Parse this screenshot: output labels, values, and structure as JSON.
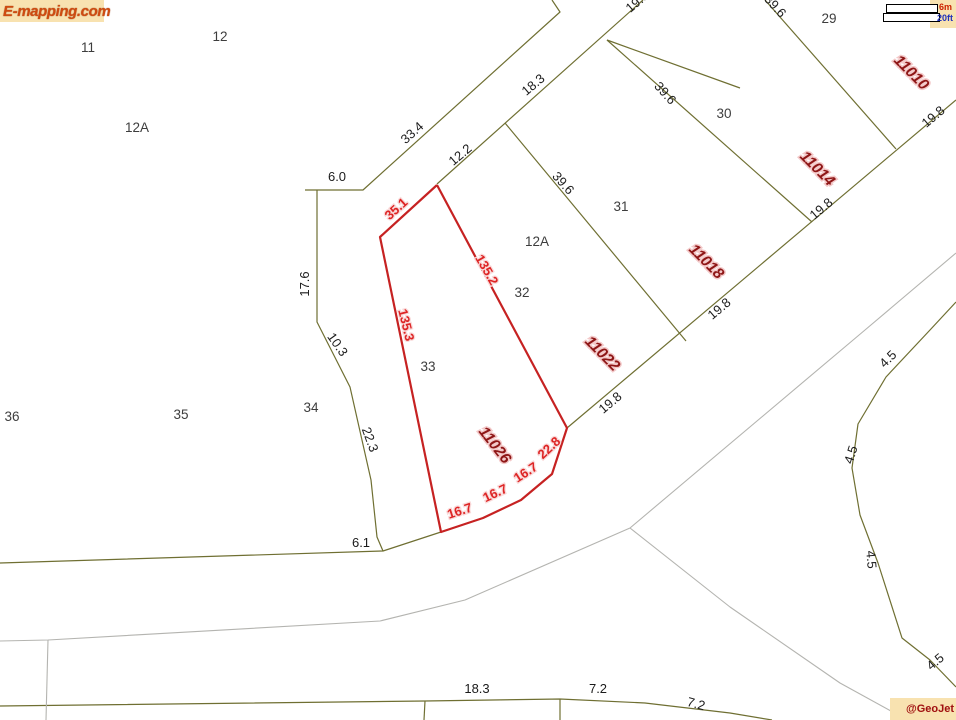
{
  "branding": {
    "logo": "E-mapping.com",
    "credit": "@GeoJet"
  },
  "scalebar": {
    "metric": "6m",
    "imperial": "20ft"
  },
  "colors": {
    "parcel": "#6f6f32",
    "road": "#b4b4b0",
    "highlight": "#c62222",
    "dim_text": "#1b1b1b",
    "lot_text": "#3d3d3d",
    "address_text": "#8e1616",
    "red_dim_text": "#dd2424",
    "badge_bg": "#f8e2b0",
    "logo_text": "#cf4b10",
    "scale_metric": "#cc2200",
    "scale_imperial": "#2233bb"
  },
  "map": {
    "width": 956,
    "height": 720,
    "lines": [
      {
        "name": "road-upper-left-edge",
        "stroke": "parcel",
        "width": 1.2,
        "points": [
          [
            305,
            190
          ],
          [
            363,
            190
          ],
          [
            560,
            12
          ],
          [
            552,
            0
          ]
        ]
      },
      {
        "name": "road-upper-right-edge",
        "stroke": "parcel",
        "width": 1.2,
        "points": [
          [
            437,
            184
          ],
          [
            643,
            0
          ]
        ]
      },
      {
        "name": "lot-line-32-31",
        "stroke": "parcel",
        "width": 1.2,
        "points": [
          [
            505,
            123
          ],
          [
            686,
            341
          ]
        ]
      },
      {
        "name": "lot-line-31-30",
        "stroke": "parcel",
        "width": 1.2,
        "points": [
          [
            607,
            40
          ],
          [
            812,
            222
          ]
        ]
      },
      {
        "name": "block-rear-line",
        "stroke": "parcel",
        "width": 1.2,
        "points": [
          [
            607,
            40
          ],
          [
            740,
            88
          ]
        ]
      },
      {
        "name": "lot-line-30-29",
        "stroke": "parcel",
        "width": 1.2,
        "points": [
          [
            765,
            0
          ],
          [
            896,
            149
          ]
        ]
      },
      {
        "name": "street-frontage-line",
        "stroke": "parcel",
        "width": 1.2,
        "points": [
          [
            567,
            428
          ],
          [
            956,
            100
          ]
        ]
      },
      {
        "name": "left-boundary",
        "stroke": "parcel",
        "width": 1.2,
        "points": [
          [
            317,
            190
          ],
          [
            317,
            322
          ],
          [
            350,
            387
          ],
          [
            371,
            480
          ],
          [
            377,
            537
          ],
          [
            383,
            551
          ]
        ]
      },
      {
        "name": "west-boundary",
        "stroke": "parcel",
        "width": 1.2,
        "points": [
          [
            0,
            563
          ],
          [
            383,
            551
          ],
          [
            441,
            532
          ]
        ]
      },
      {
        "name": "bottom-boundary",
        "stroke": "parcel",
        "width": 1.2,
        "points": [
          [
            0,
            706
          ],
          [
            425,
            701
          ],
          [
            560,
            699
          ],
          [
            645,
            703
          ],
          [
            730,
            713
          ],
          [
            772,
            720
          ]
        ]
      },
      {
        "name": "bottom-lot-tick-1",
        "stroke": "parcel",
        "width": 1.2,
        "points": [
          [
            425,
            701
          ],
          [
            424,
            720
          ]
        ]
      },
      {
        "name": "bottom-lot-tick-2",
        "stroke": "parcel",
        "width": 1.2,
        "points": [
          [
            560,
            699
          ],
          [
            560,
            720
          ]
        ]
      },
      {
        "name": "culdesac-curve",
        "stroke": "parcel",
        "width": 1.2,
        "points": [
          [
            956,
            302
          ],
          [
            930,
            330
          ],
          [
            886,
            377
          ],
          [
            858,
            424
          ],
          [
            852,
            468
          ],
          [
            860,
            515
          ],
          [
            878,
            563
          ],
          [
            902,
            638
          ],
          [
            930,
            660
          ],
          [
            956,
            687
          ]
        ]
      },
      {
        "name": "road-sw-edge",
        "stroke": "road",
        "width": 1.1,
        "points": [
          [
            0,
            641
          ],
          [
            48,
            640
          ],
          [
            380,
            621
          ],
          [
            465,
            600
          ],
          [
            630,
            528
          ]
        ]
      },
      {
        "name": "road-sw-stub",
        "stroke": "road",
        "width": 1.1,
        "points": [
          [
            48,
            640
          ],
          [
            46,
            720
          ]
        ]
      },
      {
        "name": "road-se-edge",
        "stroke": "road",
        "width": 1.1,
        "points": [
          [
            630,
            528
          ],
          [
            730,
            607
          ],
          [
            840,
            683
          ],
          [
            900,
            716
          ]
        ]
      },
      {
        "name": "road-ne-edge",
        "stroke": "road",
        "width": 1.1,
        "points": [
          [
            630,
            528
          ],
          [
            865,
            330
          ],
          [
            956,
            253
          ]
        ]
      },
      {
        "name": "highlight-parcel-33",
        "stroke": "highlight",
        "width": 2.2,
        "points": [
          [
            437,
            185
          ],
          [
            380,
            237
          ],
          [
            441,
            532
          ],
          [
            483,
            518
          ],
          [
            521,
            500
          ],
          [
            552,
            474
          ],
          [
            567,
            428
          ],
          [
            437,
            185
          ]
        ]
      }
    ],
    "labels": [
      {
        "name": "dim-label",
        "style": "dim",
        "text": "33.4",
        "x": 415,
        "y": 136,
        "rot": -42
      },
      {
        "name": "dim-label",
        "style": "dim",
        "text": "12.2",
        "x": 463,
        "y": 158,
        "rot": -40
      },
      {
        "name": "dim-label",
        "style": "dim",
        "text": "18.3",
        "x": 536,
        "y": 88,
        "rot": -40
      },
      {
        "name": "dim-label",
        "style": "dim",
        "text": "39.6",
        "x": 560,
        "y": 186,
        "rot": 48
      },
      {
        "name": "dim-label",
        "style": "dim",
        "text": "39.6",
        "x": 662,
        "y": 96,
        "rot": 48
      },
      {
        "name": "dim-label",
        "style": "dim",
        "text": "39.6",
        "x": 772,
        "y": 9,
        "rot": 48
      },
      {
        "name": "dim-label",
        "style": "dim",
        "text": "19.8",
        "x": 640,
        "y": 5,
        "rot": -40
      },
      {
        "name": "dim-label",
        "style": "dim",
        "text": "19.8",
        "x": 613,
        "y": 406,
        "rot": -40
      },
      {
        "name": "dim-label",
        "style": "dim",
        "text": "19.8",
        "x": 722,
        "y": 312,
        "rot": -40
      },
      {
        "name": "dim-label",
        "style": "dim",
        "text": "19.8",
        "x": 824,
        "y": 212,
        "rot": -40
      },
      {
        "name": "dim-label",
        "style": "dim",
        "text": "19.8",
        "x": 936,
        "y": 120,
        "rot": -40
      },
      {
        "name": "dim-label",
        "style": "dim",
        "text": "6.0",
        "x": 337,
        "y": 181,
        "rot": 0
      },
      {
        "name": "dim-label",
        "style": "dim",
        "text": "17.6",
        "x": 309,
        "y": 284,
        "rot": -90
      },
      {
        "name": "dim-label",
        "style": "dim",
        "text": "10.3",
        "x": 334,
        "y": 347,
        "rot": 55
      },
      {
        "name": "dim-label",
        "style": "dim",
        "text": "22.3",
        "x": 366,
        "y": 441,
        "rot": 70
      },
      {
        "name": "dim-label",
        "style": "dim",
        "text": "6.1",
        "x": 361,
        "y": 547,
        "rot": 0
      },
      {
        "name": "dim-label",
        "style": "dim",
        "text": "4.5",
        "x": 891,
        "y": 362,
        "rot": -45
      },
      {
        "name": "dim-label",
        "style": "dim",
        "text": "4.5",
        "x": 855,
        "y": 456,
        "rot": -72
      },
      {
        "name": "dim-label",
        "style": "dim",
        "text": "4.5",
        "x": 867,
        "y": 560,
        "rot": 85
      },
      {
        "name": "dim-label",
        "style": "dim",
        "text": "4.5",
        "x": 938,
        "y": 665,
        "rot": -40
      },
      {
        "name": "dim-label",
        "style": "dim",
        "text": "18.3",
        "x": 477,
        "y": 693,
        "rot": 0
      },
      {
        "name": "dim-label",
        "style": "dim",
        "text": "7.2",
        "x": 598,
        "y": 693,
        "rot": 0
      },
      {
        "name": "dim-label",
        "style": "dim",
        "text": "7.2",
        "x": 695,
        "y": 708,
        "rot": 15
      },
      {
        "name": "lot-number",
        "style": "lot",
        "text": "11",
        "x": 88,
        "y": 52,
        "rot": 0
      },
      {
        "name": "lot-number",
        "style": "lot",
        "text": "12",
        "x": 220,
        "y": 41,
        "rot": 0
      },
      {
        "name": "lot-number",
        "style": "lot",
        "text": "12A",
        "x": 137,
        "y": 132,
        "rot": 0
      },
      {
        "name": "lot-number",
        "style": "lot",
        "text": "12A",
        "x": 537,
        "y": 246,
        "rot": 0
      },
      {
        "name": "lot-number",
        "style": "lot",
        "text": "29",
        "x": 829,
        "y": 23,
        "rot": 0
      },
      {
        "name": "lot-number",
        "style": "lot",
        "text": "30",
        "x": 724,
        "y": 118,
        "rot": 0
      },
      {
        "name": "lot-number",
        "style": "lot",
        "text": "31",
        "x": 621,
        "y": 211,
        "rot": 0
      },
      {
        "name": "lot-number",
        "style": "lot",
        "text": "32",
        "x": 522,
        "y": 297,
        "rot": 0
      },
      {
        "name": "lot-number",
        "style": "lot",
        "text": "33",
        "x": 428,
        "y": 371,
        "rot": 0
      },
      {
        "name": "lot-number",
        "style": "lot",
        "text": "34",
        "x": 311,
        "y": 412,
        "rot": 0
      },
      {
        "name": "lot-number",
        "style": "lot",
        "text": "35",
        "x": 181,
        "y": 419,
        "rot": 0
      },
      {
        "name": "lot-number",
        "style": "lot",
        "text": "36",
        "x": 12,
        "y": 421,
        "rot": 0
      },
      {
        "name": "address-label",
        "style": "addr",
        "text": "11010",
        "x": 908,
        "y": 76,
        "rot": 45
      },
      {
        "name": "address-label",
        "style": "addr",
        "text": "11014",
        "x": 814,
        "y": 172,
        "rot": 45
      },
      {
        "name": "address-label",
        "style": "addr",
        "text": "11018",
        "x": 703,
        "y": 265,
        "rot": 45
      },
      {
        "name": "address-label",
        "style": "addr",
        "text": "11022",
        "x": 599,
        "y": 357,
        "rot": 45
      },
      {
        "name": "address-label",
        "style": "addr",
        "text": "11026",
        "x": 491,
        "y": 448,
        "rot": 52
      },
      {
        "name": "red-dim-label",
        "style": "dimred",
        "text": "35.1",
        "x": 399,
        "y": 212,
        "rot": -42
      },
      {
        "name": "red-dim-label",
        "style": "dimred",
        "text": "135.2",
        "x": 483,
        "y": 272,
        "rot": 60
      },
      {
        "name": "red-dim-label",
        "style": "dimred",
        "text": "135.3",
        "x": 402,
        "y": 326,
        "rot": 76
      },
      {
        "name": "red-dim-label",
        "style": "dimred",
        "text": "16.7",
        "x": 461,
        "y": 515,
        "rot": -18
      },
      {
        "name": "red-dim-label",
        "style": "dimred",
        "text": "16.7",
        "x": 497,
        "y": 497,
        "rot": -25
      },
      {
        "name": "red-dim-label",
        "style": "dimred",
        "text": "16.7",
        "x": 528,
        "y": 476,
        "rot": -33
      },
      {
        "name": "red-dim-label",
        "style": "dimred",
        "text": "22.8",
        "x": 552,
        "y": 451,
        "rot": -43
      }
    ]
  }
}
